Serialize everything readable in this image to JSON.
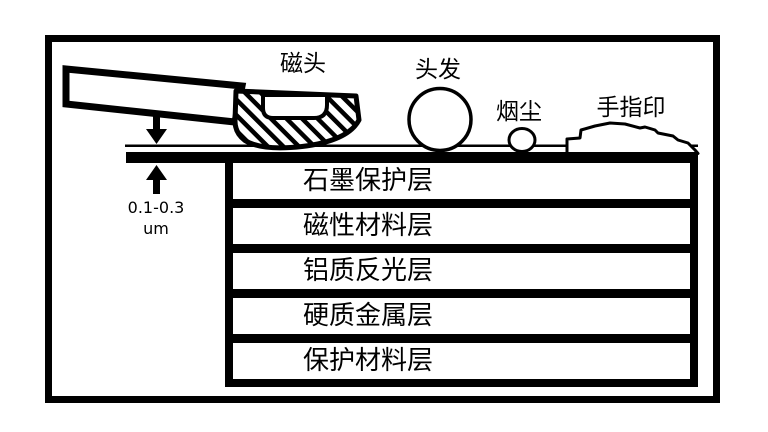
{
  "diagram": {
    "head": {
      "label": "磁头"
    },
    "contaminants": {
      "hair": {
        "label": "头发"
      },
      "dust": {
        "label": "烟尘"
      },
      "fingerprint": {
        "label": "手指印"
      }
    },
    "flying_gap": {
      "value": "0.1-0.3",
      "unit": "um"
    },
    "disk_layers": [
      {
        "label": "石墨保护层"
      },
      {
        "label": "磁性材料层"
      },
      {
        "label": "铝质反光层"
      },
      {
        "label": "硬质金属层"
      },
      {
        "label": "保护材料层"
      }
    ],
    "colors": {
      "ink": "#000000",
      "background": "#ffffff"
    }
  }
}
